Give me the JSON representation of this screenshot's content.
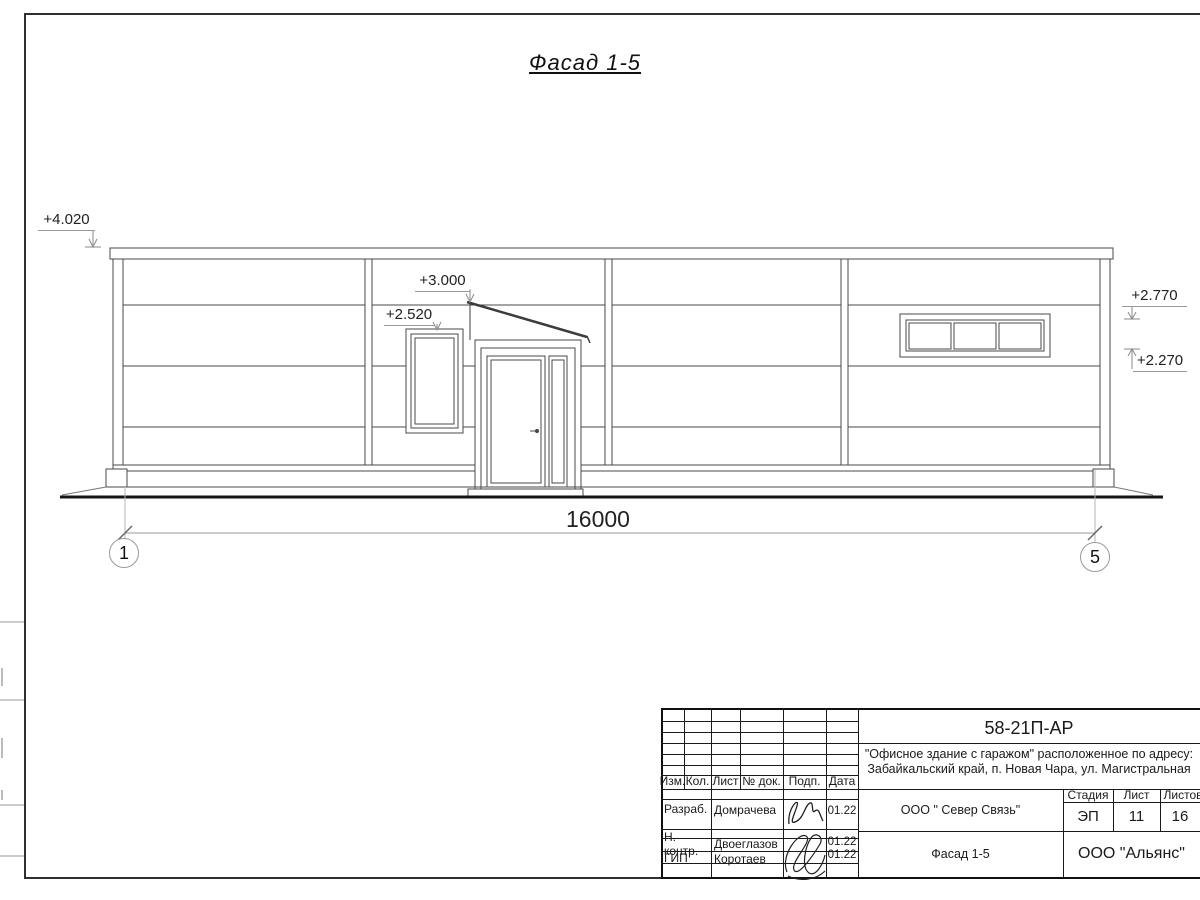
{
  "sheet": {
    "title": "Фасад 1-5",
    "dimension_total": "16000",
    "grid_axis_left": "1",
    "grid_axis_right": "5",
    "elev_parapet": "+4.020",
    "elev_canopy": "+3.000",
    "elev_window_head": "+2.520",
    "elev_ribbon_top": "+2.770",
    "elev_ribbon_bottom": "+2.270"
  },
  "title_block": {
    "doc_number": "58-21П-АР",
    "address1": "\"Офисное здание с гаражом\" расположенное по адресу:",
    "address2": "Забайкальский край, п. Новая Чара, ул. Магистральная",
    "col_izm": "Изм.",
    "col_kol": "Кол.",
    "col_list": "Лист",
    "col_doc": "№ док.",
    "col_podp": "Подп.",
    "col_data": "Дата",
    "rows": [
      {
        "role": "Разраб.",
        "name": "Домрачева",
        "date": "01.22"
      },
      {
        "role": "Н. контр.",
        "name": "Двоеглазов",
        "date": "01.22"
      },
      {
        "role": "ГИП",
        "name": "Коротаев",
        "date": "01.22"
      }
    ],
    "org": "ООО \" Север Связь\"",
    "stage_label": "Стадия",
    "list_label": "Лист",
    "listov_label": "Листов",
    "stage": "ЭП",
    "sheet_no": "11",
    "sheets_total": "16",
    "object_name": "Фасад 1-5",
    "company": "ООО \"Альянс\""
  }
}
